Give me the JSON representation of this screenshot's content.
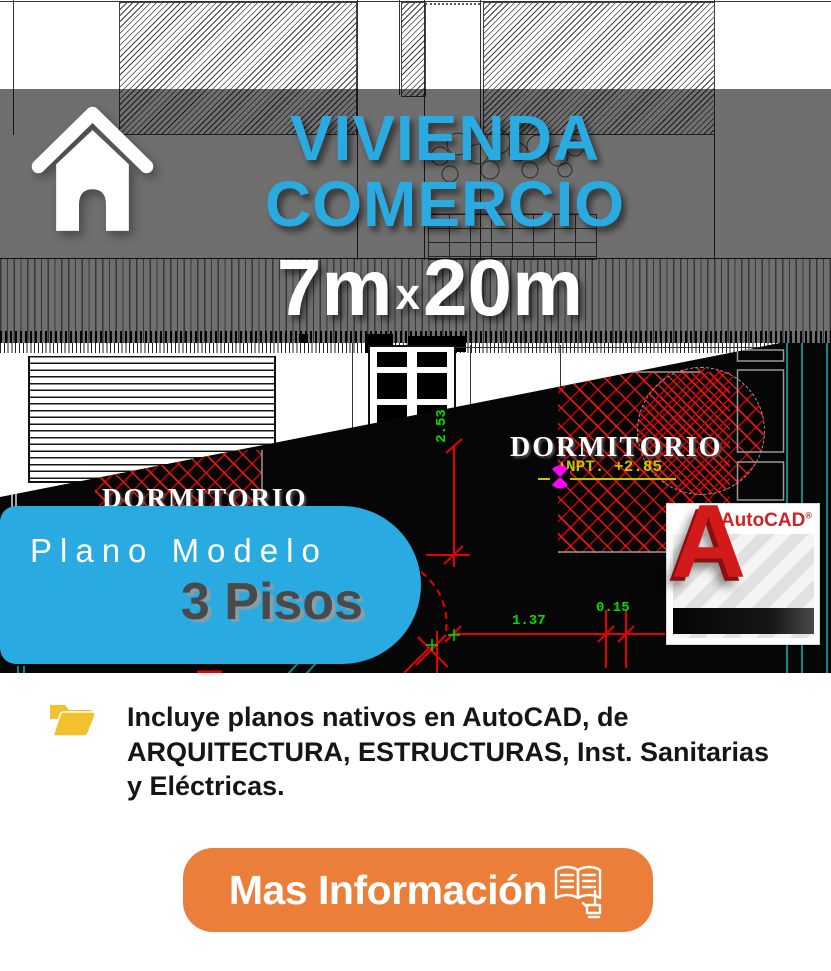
{
  "headline": {
    "line1": "VIVIENDA",
    "line2": "COMERCIO",
    "size_a": "7m",
    "size_x": "x",
    "size_b": "20m"
  },
  "ribbon": {
    "line1": "Plano Modelo",
    "line2": "3 Pisos"
  },
  "autocad": {
    "brand": "AutoCAD",
    "registered": "®",
    "letter": "A"
  },
  "cad": {
    "room_left": "DORMITORIO",
    "room_right": "DORMITORIO",
    "npt": "NPT. +2.85",
    "dim_height": "2.53",
    "dim_width1": "1.37",
    "dim_width2": "0.15"
  },
  "info": {
    "line1": "Incluye planos nativos en AutoCAD, de",
    "line2": "ARQUITECTURA, ESTRUCTURAS, Inst. Sanitarias",
    "line3": "y Eléctricas."
  },
  "cta": {
    "label": "Mas Información"
  },
  "icons": {
    "house": "house-icon",
    "folder": "open-folder-icon",
    "book_hand": "open-book-with-hand-icon",
    "pushpin": "magenta-marker-icon"
  },
  "colors": {
    "cyan": "#29ABE2",
    "orange": "#EB7F3A",
    "gold": "#F1C12E",
    "cad_red": "#E60000",
    "dim_green": "#00DD00",
    "npt_yellow": "#BFC800",
    "magenta": "#FF00FF",
    "teal": "#0E8A8A",
    "autocad_red": "#CE2424",
    "dark_grey_text": "#4A4A4A"
  }
}
